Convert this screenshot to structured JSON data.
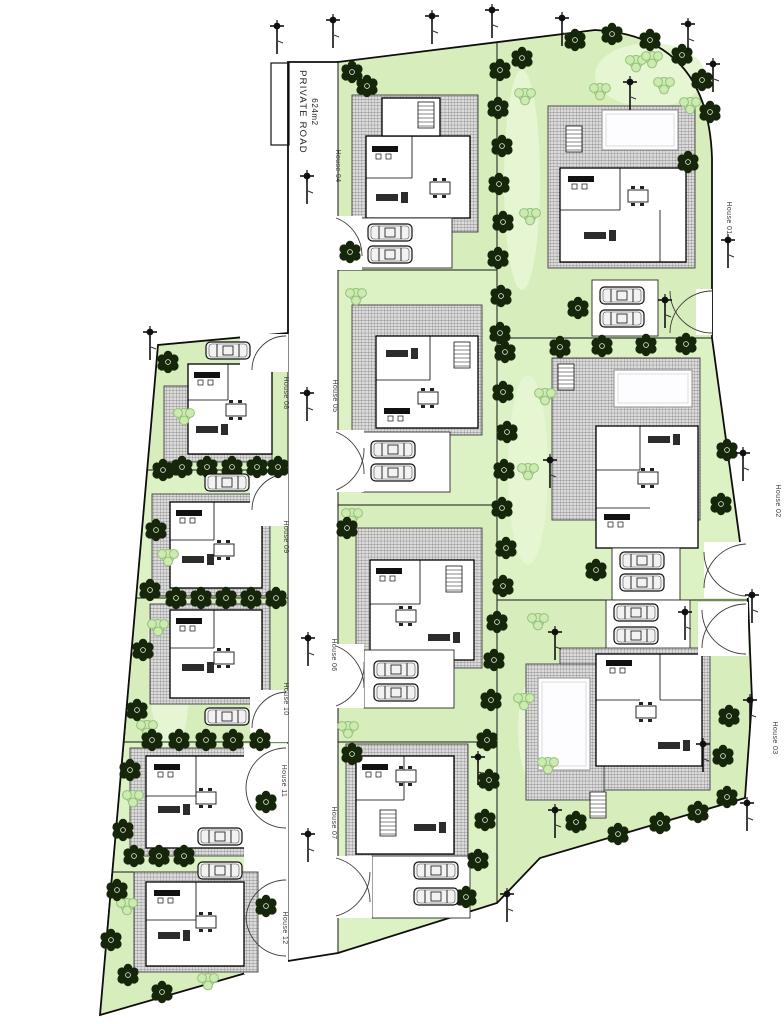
{
  "plan": {
    "road_label": {
      "line1": "PRIVATE ROAD",
      "line2": "624m2"
    },
    "houses": [
      {
        "id": "house-01",
        "label": "House 01"
      },
      {
        "id": "house-02",
        "label": "House 02"
      },
      {
        "id": "house-03",
        "label": "House 03"
      },
      {
        "id": "house-04",
        "label": "House 04"
      },
      {
        "id": "house-05",
        "label": "House 05"
      },
      {
        "id": "house-06",
        "label": "House 06"
      },
      {
        "id": "house-07",
        "label": "House 07"
      },
      {
        "id": "house-08",
        "label": "House 08"
      },
      {
        "id": "house-09",
        "label": "House 09"
      },
      {
        "id": "house-10",
        "label": "House 10"
      },
      {
        "id": "house-11",
        "label": "House 11"
      },
      {
        "id": "house-12",
        "label": "House 12"
      }
    ]
  },
  "colors": {
    "lawn": "#d7eebc",
    "lawn_light": "#e6f5d2",
    "tree": "#16260a",
    "shrub": "#cdeab0",
    "paving_base": "#dcdcdc",
    "paving_line": "#6f6f6f"
  },
  "scatter": {
    "trees": [
      [
        500,
        70
      ],
      [
        498,
        108
      ],
      [
        502,
        146
      ],
      [
        499,
        184
      ],
      [
        503,
        222
      ],
      [
        498,
        258
      ],
      [
        501,
        296
      ],
      [
        500,
        333
      ],
      [
        505,
        352
      ],
      [
        503,
        392
      ],
      [
        507,
        432
      ],
      [
        504,
        470
      ],
      [
        502,
        508
      ],
      [
        506,
        548
      ],
      [
        503,
        586
      ],
      [
        497,
        622
      ],
      [
        494,
        660
      ],
      [
        491,
        700
      ],
      [
        487,
        740
      ],
      [
        489,
        780
      ],
      [
        485,
        820
      ],
      [
        478,
        860
      ],
      [
        466,
        897
      ],
      [
        352,
        72
      ],
      [
        367,
        86
      ],
      [
        350,
        252
      ],
      [
        347,
        528
      ],
      [
        352,
        754
      ],
      [
        575,
        40
      ],
      [
        612,
        34
      ],
      [
        650,
        40
      ],
      [
        682,
        55
      ],
      [
        702,
        80
      ],
      [
        710,
        112
      ],
      [
        688,
        162
      ],
      [
        578,
        308
      ],
      [
        522,
        58
      ],
      [
        560,
        347
      ],
      [
        602,
        346
      ],
      [
        646,
        345
      ],
      [
        686,
        344
      ],
      [
        596,
        570
      ],
      [
        727,
        450
      ],
      [
        721,
        504
      ],
      [
        576,
        822
      ],
      [
        618,
        834
      ],
      [
        660,
        823
      ],
      [
        698,
        812
      ],
      [
        727,
        797
      ],
      [
        729,
        716
      ],
      [
        723,
        756
      ],
      [
        163,
        470
      ],
      [
        156,
        530
      ],
      [
        150,
        590
      ],
      [
        143,
        650
      ],
      [
        137,
        710
      ],
      [
        130,
        770
      ],
      [
        123,
        830
      ],
      [
        117,
        890
      ],
      [
        111,
        940
      ],
      [
        128,
        975
      ],
      [
        162,
        992
      ],
      [
        182,
        467
      ],
      [
        207,
        467
      ],
      [
        232,
        467
      ],
      [
        257,
        467
      ],
      [
        278,
        467
      ],
      [
        176,
        598
      ],
      [
        201,
        598
      ],
      [
        226,
        598
      ],
      [
        251,
        598
      ],
      [
        276,
        598
      ],
      [
        152,
        740
      ],
      [
        179,
        740
      ],
      [
        206,
        740
      ],
      [
        233,
        740
      ],
      [
        260,
        740
      ],
      [
        134,
        856
      ],
      [
        159,
        856
      ],
      [
        184,
        856
      ],
      [
        266,
        802
      ],
      [
        266,
        906
      ],
      [
        168,
        362
      ]
    ],
    "shrubs": [
      [
        636,
        62
      ],
      [
        664,
        84
      ],
      [
        690,
        104
      ],
      [
        525,
        95
      ],
      [
        530,
        215
      ],
      [
        545,
        395
      ],
      [
        528,
        470
      ],
      [
        538,
        620
      ],
      [
        524,
        700
      ],
      [
        548,
        764
      ],
      [
        184,
        415
      ],
      [
        168,
        556
      ],
      [
        158,
        626
      ],
      [
        147,
        727
      ],
      [
        133,
        797
      ],
      [
        127,
        905
      ],
      [
        208,
        980
      ],
      [
        356,
        295
      ],
      [
        352,
        515
      ],
      [
        348,
        728
      ],
      [
        652,
        58
      ],
      [
        600,
        90
      ]
    ],
    "lamps": [
      [
        277,
        26
      ],
      [
        333,
        20
      ],
      [
        432,
        16
      ],
      [
        492,
        10
      ],
      [
        562,
        18
      ],
      [
        688,
        24
      ],
      [
        713,
        64
      ],
      [
        630,
        82
      ],
      [
        728,
        240
      ],
      [
        665,
        300
      ],
      [
        307,
        176
      ],
      [
        307,
        393
      ],
      [
        308,
        638
      ],
      [
        308,
        834
      ],
      [
        150,
        332
      ],
      [
        550,
        460
      ],
      [
        743,
        453
      ],
      [
        752,
        595
      ],
      [
        685,
        612
      ],
      [
        555,
        632
      ],
      [
        703,
        744
      ],
      [
        750,
        700
      ],
      [
        747,
        803
      ],
      [
        555,
        810
      ],
      [
        478,
        757
      ],
      [
        507,
        894
      ]
    ],
    "cars": [
      [
        600,
        287
      ],
      [
        600,
        310
      ],
      [
        620,
        552
      ],
      [
        620,
        574
      ],
      [
        614,
        604
      ],
      [
        614,
        627
      ],
      [
        368,
        224
      ],
      [
        368,
        246
      ],
      [
        371,
        441
      ],
      [
        371,
        464
      ],
      [
        374,
        661
      ],
      [
        374,
        684
      ],
      [
        414,
        862
      ],
      [
        414,
        888
      ],
      [
        206,
        342
      ],
      [
        205,
        474
      ],
      [
        205,
        708
      ],
      [
        198,
        828
      ],
      [
        198,
        862
      ]
    ]
  }
}
